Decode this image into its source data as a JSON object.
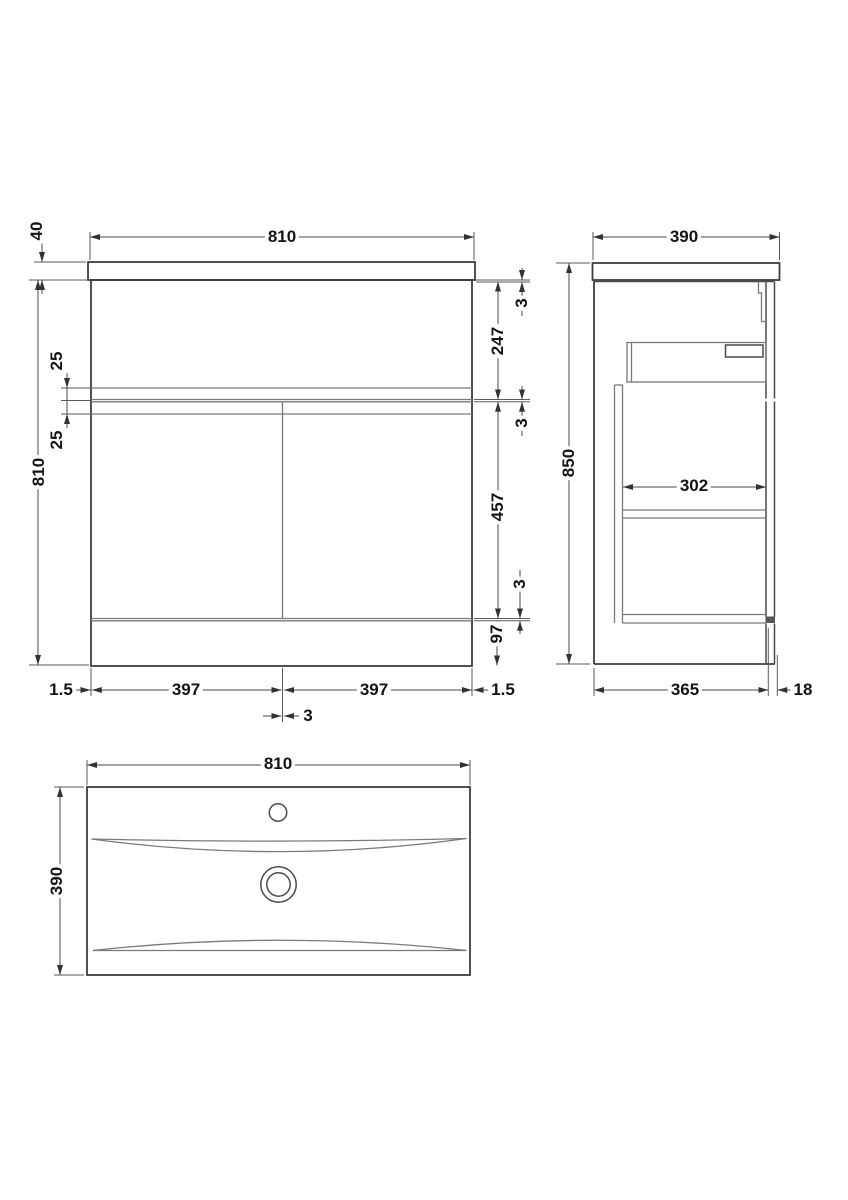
{
  "drawing": {
    "kind": "vanity-unit-dimension-drawing",
    "units": "mm",
    "front_view": {
      "overall_width": "810",
      "worktop_thickness": "40",
      "carcass_height": "810",
      "drawer_groove": "25",
      "door_groove": "25",
      "top_gap": "3",
      "drawer_front_height": "247",
      "mid_gap": "3",
      "door_height": "457",
      "bottom_gap": "3",
      "plinth_height": "97",
      "left_gap": "1.5",
      "left_door_width": "397",
      "right_door_width": "397",
      "right_gap": "1.5",
      "centre_gap": "3"
    },
    "side_view": {
      "overall_depth": "390",
      "overall_height": "850",
      "internal_depth": "302",
      "carcass_depth": "365",
      "door_thickness": "18"
    },
    "plan_view": {
      "basin_width": "810",
      "basin_depth": "390"
    }
  }
}
